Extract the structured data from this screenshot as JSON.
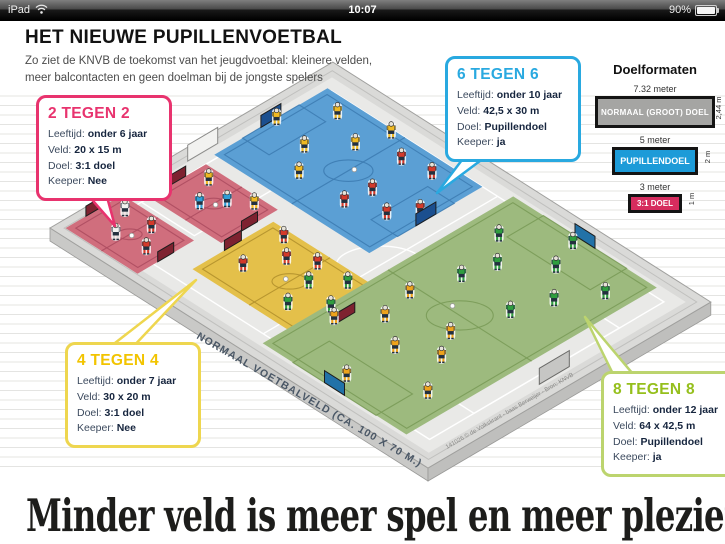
{
  "status_bar": {
    "device": "iPad",
    "time": "10:07",
    "battery": "90%"
  },
  "infographic": {
    "title": "HET NIEUWE PUPILLENVOETBAL",
    "subtitle": "Zo ziet de KNVB de toekomst van het jeugdvoetbal: kleinere velden, meer balcontacten en geen doelman bij de jongste spelers",
    "field_label": "NORMAAL VOETBALVELD (CA. 100 X 70 M.)",
    "credit": "141026 © de Volkskrant - baas Berweijer - Bron: KNVB",
    "callouts": [
      {
        "id": "2v2",
        "title": "2 TEGEN 2",
        "color": "#e8336e",
        "title_color": "#e8336e",
        "rows": [
          {
            "label": "Leeftijd:",
            "value": "onder 6 jaar"
          },
          {
            "label": "Veld:",
            "value": "20 x 15 m"
          },
          {
            "label": "Doel:",
            "value": "3:1 doel"
          },
          {
            "label": "Keeper:",
            "value": "Nee"
          }
        ]
      },
      {
        "id": "4v4",
        "title": "4 TEGEN 4",
        "color": "#eed64f",
        "title_color": "#f2c400",
        "rows": [
          {
            "label": "Leeftijd:",
            "value": "onder 7 jaar"
          },
          {
            "label": "Veld:",
            "value": "30 x 20 m"
          },
          {
            "label": "Doel:",
            "value": "3:1 doel"
          },
          {
            "label": "Keeper:",
            "value": "Nee"
          }
        ]
      },
      {
        "id": "6v6",
        "title": "6 TEGEN 6",
        "color": "#29a9e0",
        "title_color": "#29a9e0",
        "rows": [
          {
            "label": "Leeftijd:",
            "value": "onder 10 jaar"
          },
          {
            "label": "Veld:",
            "value": "42,5 x 30 m"
          },
          {
            "label": "Doel:",
            "value": "Pupillendoel"
          },
          {
            "label": "Keeper:",
            "value": "ja"
          }
        ]
      },
      {
        "id": "8v8",
        "title": "8 TEGEN 8",
        "color": "#bcd46e",
        "title_color": "#95bf1c",
        "rows": [
          {
            "label": "Leeftijd:",
            "value": "onder 12 jaar"
          },
          {
            "label": "Veld:",
            "value": "64 x 42,5 m"
          },
          {
            "label": "Doel:",
            "value": "Pupillendoel"
          },
          {
            "label": "Keeper:",
            "value": "ja"
          }
        ]
      }
    ],
    "legend": {
      "title": "Doelformaten",
      "goals": [
        {
          "name": "NORMAAL (GROOT) DOEL",
          "width_label": "7.32 meter",
          "height_label": "2,44 m",
          "color": "#a5a5a3"
        },
        {
          "name": "PUPILLENDOEL",
          "width_label": "5 meter",
          "height_label": "2 m",
          "color": "#1d9bd8"
        },
        {
          "name": "3:1 DOEL",
          "width_label": "3 meter",
          "height_label": "1 m",
          "color": "#d62c5e"
        }
      ]
    },
    "scene": {
      "platform_color": "#dadad8",
      "field_color": "#e9e9e7",
      "marking_color": "#ffffff",
      "fields": [
        {
          "id": "field-2v2-a",
          "color": "#d06e7d",
          "line_color": "#ad4d60",
          "rect": [
            2,
            2,
            21,
            16
          ],
          "axis": "x",
          "goal_color": "#7e2230",
          "goal_w": 16,
          "goal_h": 10,
          "goal_positions": [
            [
              2,
              9
            ],
            [
              21,
              9
            ]
          ],
          "team_colors": [
            "#f2f2f0",
            "#d43a2a"
          ],
          "sock_colors": [
            "#d8d8d6",
            "#d43a2a"
          ],
          "players": [
            [
              7,
              12,
              0
            ],
            [
              11,
              6,
              0
            ],
            [
              14,
              12,
              1
            ],
            [
              18,
              7,
              1
            ]
          ],
          "ball": [
            12,
            9
          ]
        },
        {
          "id": "field-2v2-b",
          "color": "#d06e7d",
          "line_color": "#ad4d60",
          "rect": [
            6,
            19,
            25,
            33
          ],
          "axis": "x",
          "goal_color": "#7e2230",
          "goal_w": 16,
          "goal_h": 10,
          "goal_positions": [
            [
              6,
              26
            ],
            [
              25,
              26
            ]
          ],
          "team_colors": [
            "#2e9fd8",
            "#f0b922"
          ],
          "sock_colors": [
            "#2e9fd8",
            "#f0b922"
          ],
          "players": [
            [
              11,
              29,
              1
            ],
            [
              15,
              23,
              0
            ],
            [
              18,
              27,
              0
            ],
            [
              22,
              30,
              1
            ]
          ],
          "ball": [
            16,
            26
          ]
        },
        {
          "id": "field-4v4",
          "color": "#e4c04a",
          "line_color": "#b3912c",
          "rect": [
            27,
            10,
            57,
            30
          ],
          "axis": "x",
          "goal_color": "#7e2230",
          "goal_w": 17,
          "goal_h": 10,
          "goal_positions": [
            [
              27,
              20
            ],
            [
              57,
              20
            ]
          ],
          "team_colors": [
            "#d43a2a",
            "#2f9e3f"
          ],
          "sock_colors": [
            "#d43a2a",
            "#2f9e3f"
          ],
          "players": [
            [
              33,
              27,
              0
            ],
            [
              38,
              23,
              0
            ],
            [
              34,
              16,
              0
            ],
            [
              43,
              26,
              0
            ],
            [
              46,
              21,
              1
            ],
            [
              51,
              26,
              1
            ],
            [
              48,
              14,
              1
            ],
            [
              54,
              19,
              1
            ]
          ],
          "ball": [
            41,
            20
          ]
        },
        {
          "id": "field-6v6",
          "color": "#5b9fd4",
          "line_color": "#3d7cb2",
          "rect": [
            5,
            36,
            46,
            64
          ],
          "axis": "x",
          "goal_color": "#1b4f8f",
          "goal_w": 20,
          "goal_h": 12,
          "goal_positions": [
            [
              5,
              50
            ],
            [
              46,
              50
            ]
          ],
          "pen_rects": [
            [
              5,
              43,
              12,
              57
            ],
            [
              39,
              43,
              46,
              57
            ]
          ],
          "team_colors": [
            "#f0b922",
            "#d43a2a"
          ],
          "sock_colors": [
            "#f0b922",
            "#d43a2a"
          ],
          "players": [
            [
              6.5,
              50,
              0
            ],
            [
              13,
              59,
              0
            ],
            [
              16,
              48,
              0
            ],
            [
              22,
              55,
              0
            ],
            [
              24,
              62,
              0
            ],
            [
              21,
              42,
              0
            ],
            [
              44.5,
              50,
              1
            ],
            [
              31,
              58,
              1
            ],
            [
              34,
              48,
              1
            ],
            [
              38,
              59,
              1
            ],
            [
              33,
              42,
              1
            ],
            [
              41,
              45,
              1
            ]
          ],
          "ball": [
            26,
            51
          ]
        },
        {
          "id": "field-8v8",
          "color": "#9dba7e",
          "line_color": "#7a9b58",
          "rect": [
            52,
            4,
            90,
            66
          ],
          "axis": "y",
          "goal_color": "#2272a8",
          "goal_w": 20,
          "goal_h": 12,
          "goal_positions": [
            [
              71,
              4
            ],
            [
              71,
              66
            ]
          ],
          "pen_rects": [
            [
              60,
              4,
              82,
              13
            ],
            [
              60,
              57,
              82,
              66
            ]
          ],
          "team_colors": [
            "#2f9e3f",
            "#efa31c"
          ],
          "sock_colors": [
            "#2f9e3f",
            "#efa31c"
          ],
          "players": [
            [
              71,
              63,
              0
            ],
            [
              60,
              55,
              0
            ],
            [
              66,
              49,
              0
            ],
            [
              74,
              56,
              0
            ],
            [
              81,
              49,
              0
            ],
            [
              64,
              42,
              0
            ],
            [
              78,
              41,
              0
            ],
            [
              86,
              57,
              0
            ],
            [
              71,
              7,
              1
            ],
            [
              57,
              17,
              1
            ],
            [
              63,
              24,
              1
            ],
            [
              71,
              19,
              1
            ],
            [
              79,
              23,
              1
            ],
            [
              61,
              32,
              1
            ],
            [
              75,
              29,
              1
            ],
            [
              85,
              14,
              1
            ]
          ],
          "ball": [
            68,
            36
          ]
        }
      ],
      "normal_goals": [
        {
          "at": [
            3,
            35
          ],
          "axis": "x",
          "color": "#f2f2f0",
          "stroke": "#8a8a88",
          "w": 30,
          "h": 16
        },
        {
          "at": [
            96,
            35
          ],
          "axis": "x",
          "color": "#c6c6c4",
          "stroke": "#6a6a68",
          "w": 30,
          "h": 16
        }
      ]
    }
  },
  "headline": "Minder veld is meer spel en meer plezier"
}
